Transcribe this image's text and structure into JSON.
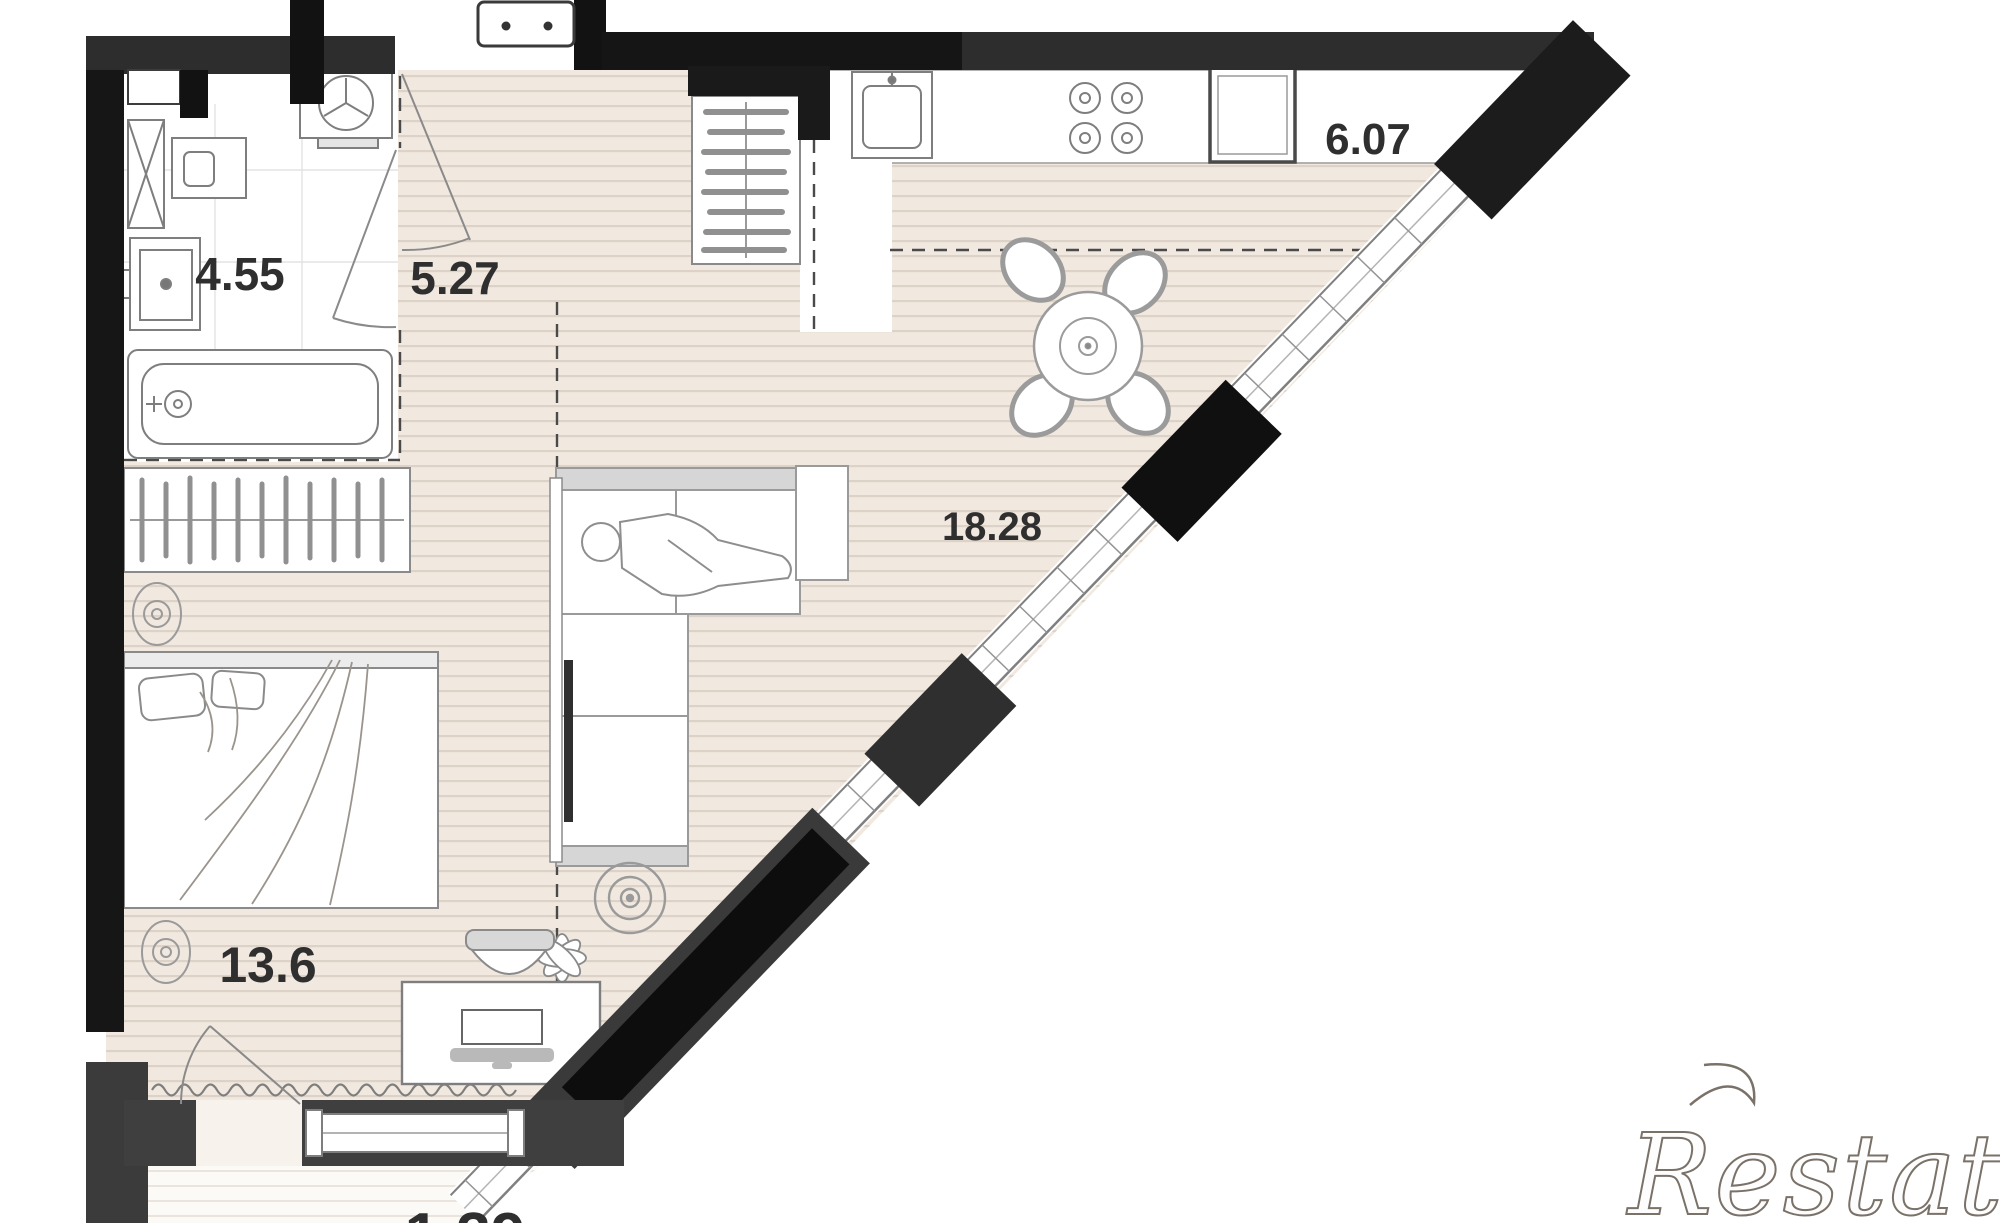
{
  "plan": {
    "type": "apartment-floor-plan",
    "units": "square-meters",
    "rooms": [
      {
        "id": "bathroom",
        "area_label": "4.55",
        "features": [
          "bathtub-icon",
          "washbasin-icon",
          "washing-machine-icon",
          "extractor-fan-icon",
          "ventilation-shaft-icon"
        ]
      },
      {
        "id": "hallway",
        "area_label": "5.27",
        "features": [
          "entry-door-icon",
          "bathroom-door-icon",
          "closet-hangers-icon"
        ]
      },
      {
        "id": "kitchen",
        "area_label": "6.07",
        "features": [
          "kitchen-sink-icon",
          "stove-burners-icon",
          "fridge-icon",
          "dining-table-icon",
          "chair-icon"
        ]
      },
      {
        "id": "living-room",
        "area_label": "18.28",
        "features": [
          "corner-sofa-icon",
          "person-icon",
          "tv-icon",
          "ceiling-fan-icon",
          "plant-icon",
          "side-table-icon"
        ]
      },
      {
        "id": "bedroom",
        "area_label": "13.6",
        "features": [
          "double-bed-icon",
          "wardrobe-hangers-icon",
          "desk-icon",
          "desk-chair-icon",
          "laptop-icon",
          "ceiling-light-icon",
          "curtain-icon"
        ]
      },
      {
        "id": "balcony",
        "area_label": "1.39",
        "features": [
          "balcony-door-icon",
          "balcony-window-icon"
        ]
      }
    ]
  },
  "watermark": {
    "text": "Restate"
  },
  "colors": {
    "wall_black": "#141414",
    "wall_dark": "#2d2d2d",
    "wall_gray": "#3f3f3f",
    "floor_beige": "#f1e8df",
    "floor_stripe": "#ddd2c7",
    "balcony_floor": "#fbfaf7",
    "line_gray": "#8a8a8a",
    "label_color": "#2f2f2f",
    "watermark_outline": "#7a7168"
  }
}
